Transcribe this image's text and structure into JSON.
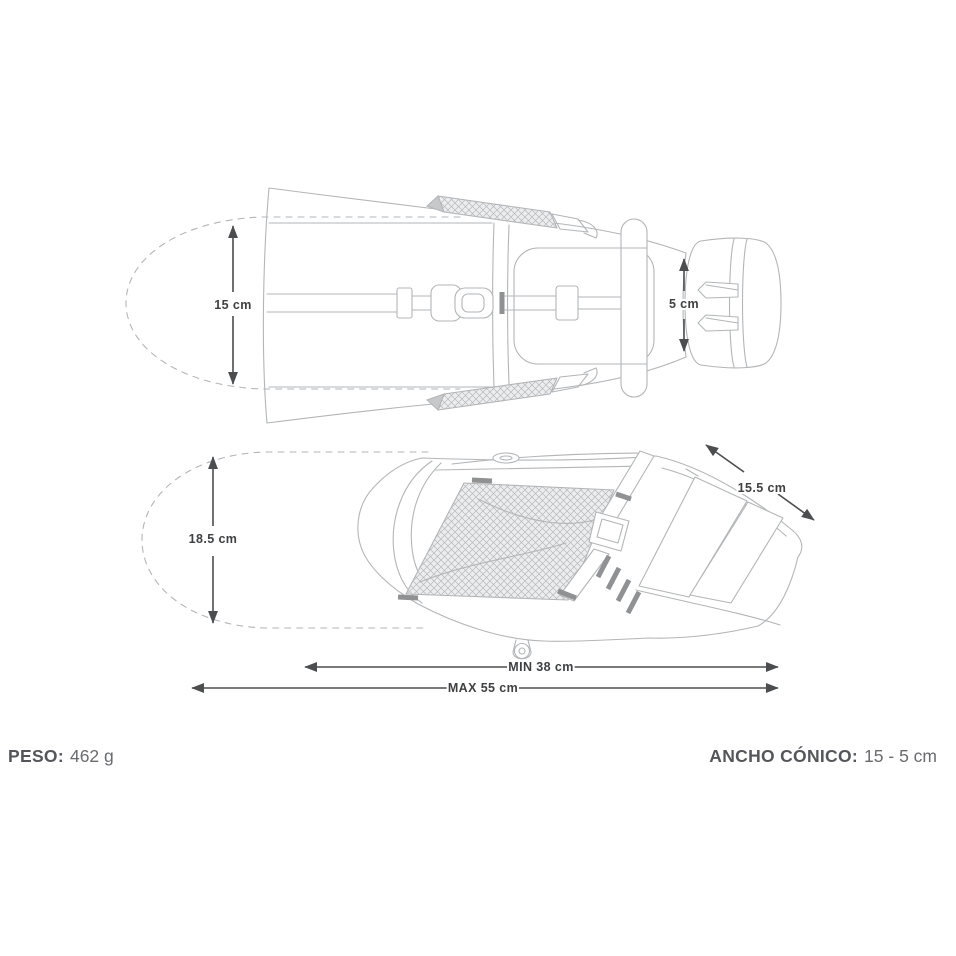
{
  "colors": {
    "background": "#ffffff",
    "line": "#b3b5b7",
    "hatchLine": "#b6b8ba",
    "hatchBg": "#ecedee",
    "fold": "#c6c8ca",
    "tick": "#8f9193",
    "dimension": "#4c4d4f",
    "label": "#3f4042",
    "specLabel": "#55565a",
    "specValue": "#6a6b6e"
  },
  "top_view": {
    "dim_width": "15 cm",
    "dim_rear_width": "5 cm"
  },
  "side_view": {
    "dim_height": "18.5 cm",
    "dim_tail": "15.5 cm",
    "dim_min_length": "MIN 38 cm",
    "dim_max_length": "MAX 55 cm"
  },
  "specs": {
    "weight_label": "PESO:",
    "weight_value": "462 g",
    "taper_label": "ANCHO CÓNICO:",
    "taper_value": "15 - 5 cm"
  }
}
